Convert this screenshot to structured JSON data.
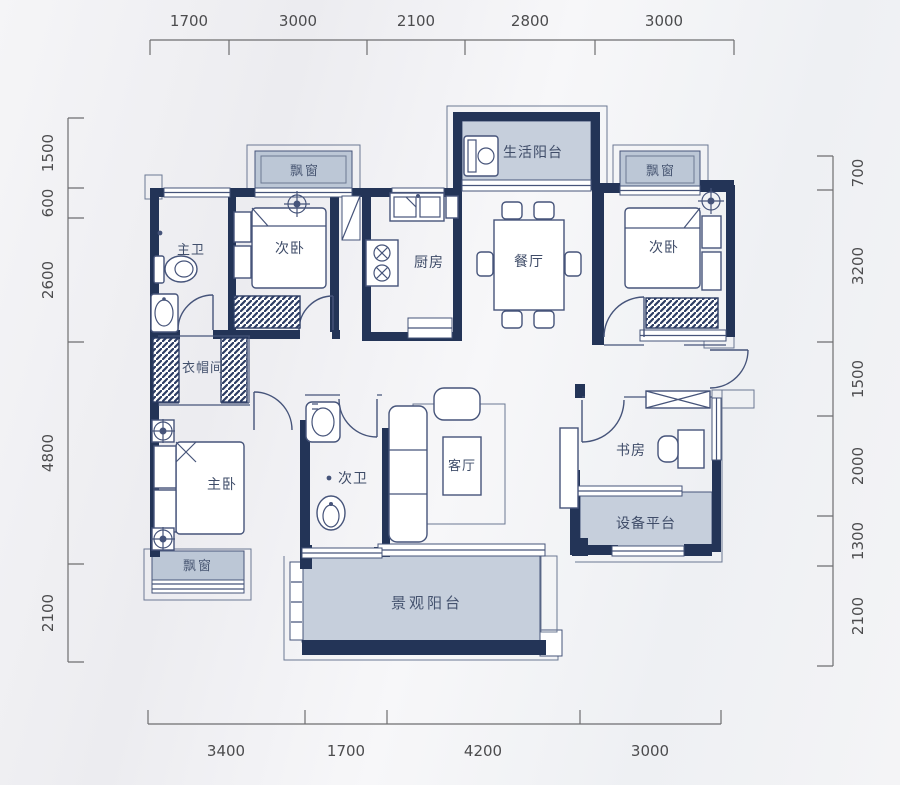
{
  "plan_type": "apartment-floor-plan",
  "colors": {
    "wall": "#233457",
    "balcony_fill": "#c6cfdc",
    "bay_window_fill": "#bcc7d6",
    "line": "#46547a",
    "dimension": "#4c4c4e",
    "background": "#f2f3f5"
  },
  "dims": {
    "top": [
      "1700",
      "3000",
      "2100",
      "2800",
      "3000"
    ],
    "bottom": [
      "3400",
      "1700",
      "4200",
      "3000"
    ],
    "left": [
      "1500",
      "600",
      "2600",
      "4800",
      "2100"
    ],
    "right": [
      "700",
      "3200",
      "1500",
      "2000",
      "1300",
      "2100"
    ]
  },
  "rooms": {
    "master_bath": "主卫",
    "bedroom_top_left": "次卧",
    "kitchen": "厨房",
    "dining": "餐厅",
    "life_balcony": "生活阳台",
    "bay_top_left": "飘窗",
    "bay_top_right": "飘窗",
    "bedroom_top_right": "次卧",
    "cloakroom": "衣帽间",
    "master_bedroom": "主卧",
    "second_bath": "次卫",
    "living": "客厅",
    "study": "书房",
    "equipment": "设备平台",
    "bay_bottom_left": "飘窗",
    "view_balcony": "景观阳台"
  }
}
